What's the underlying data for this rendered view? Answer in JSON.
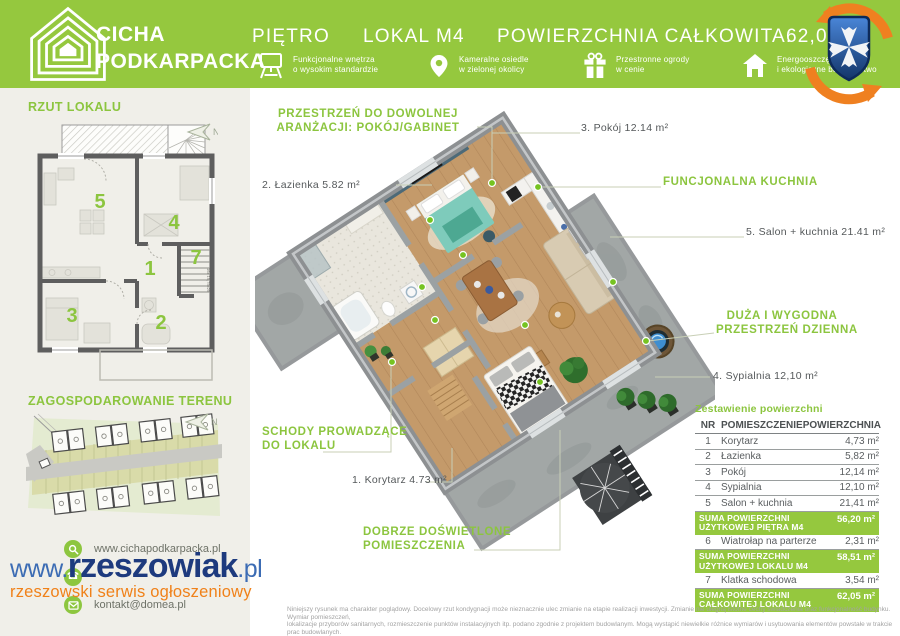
{
  "colors": {
    "green": "#95c83e",
    "green_text": "#8cc53f",
    "dark": "#54585a",
    "orange": "#f08119",
    "navy": "#1d3a7e",
    "blue": "#3c6cb4"
  },
  "header": {
    "brand_line1": "CICHA",
    "brand_line2": "PODKARPACKA",
    "floor_label": "PIĘTRO",
    "unit_label": "LOKAL M4",
    "total_area_label": "POWIERZCHNIA CAŁKOWITA:",
    "total_area_value": "62,05 m²",
    "features": [
      {
        "icon": "projector-icon",
        "line1": "Funkcjonalne wnętrza",
        "line2": "o wysokim standardzie"
      },
      {
        "icon": "map-pin-icon",
        "line1": "Kameralne osiedle",
        "line2": "w zielonej okolicy"
      },
      {
        "icon": "gift-icon",
        "line1": "Przestronne ogrody",
        "line2": "w cenie"
      },
      {
        "icon": "house-icon",
        "line1": "Energooszczędne",
        "line2": "i ekologiczne budownictwo"
      }
    ]
  },
  "sidebar": {
    "plan_title": "RZUT LOKALU",
    "site_title": "ZAGOSPODAROWANIE TERENU",
    "north_label": "N",
    "room_numbers": {
      "r1": "1",
      "r2": "2",
      "r3": "3",
      "r4": "4",
      "r5": "5",
      "r7": "7"
    },
    "stairs_note": "16x 19,75x25",
    "contacts": [
      {
        "icon": "search-icon",
        "label": "www.cichapodkarpacka.pl"
      },
      {
        "icon": "phone-icon",
        "label": ""
      },
      {
        "icon": "mail-icon",
        "label": "kontakt@domea.pl"
      }
    ]
  },
  "plan_labels": {
    "arrangement_line1": "PRZESTRZEŃ DO DOWOLNEJ",
    "arrangement_line2": "ARANŻACJI: POKÓJ/GABINET",
    "bathroom": "2. Łazienka 5.82 m²",
    "room3": "3. Pokój 12.14 m²",
    "kitchen": "FUNCJONALNA KUCHNIA",
    "living": "5. Salon + kuchnia 21.41 m²",
    "zone_line1": "DUŻA I WYGODNA",
    "zone_line2": "PRZESTRZEŃ DZIENNA",
    "bedroom": "4. Sypialnia 12,10 m²",
    "stairs_line1": "SCHODY PROWADZĄCE",
    "stairs_line2": "DO LOKALU",
    "corridor": "1. Korytarz 4.73 m²",
    "light_line1": "DOBRZE DOŚWIETLONE",
    "light_line2": "POMIESZCZENIA"
  },
  "area_table": {
    "title": "Zestawienie powierzchni",
    "columns": {
      "nr": "NR",
      "name": "POMIESZCZENIE",
      "area": "POWIERZCHNIA"
    },
    "rows": [
      {
        "nr": "1",
        "name": "Korytarz",
        "area": "4,73 m²"
      },
      {
        "nr": "2",
        "name": "Łazienka",
        "area": "5,82 m²"
      },
      {
        "nr": "3",
        "name": "Pokój",
        "area": "12,14 m²"
      },
      {
        "nr": "4",
        "name": "Sypialnia",
        "area": "12,10 m²"
      },
      {
        "nr": "5",
        "name": "Salon + kuchnia",
        "area": "21,41 m²"
      },
      {
        "name": "SUMA POWIERZCHNI UŻYTKOWEJ PIĘTRA M4",
        "area": "56,20 m²"
      },
      {
        "nr": "6",
        "name": "Wiatrołap na parterze",
        "area": "2,31 m²"
      },
      {
        "name": "SUMA POWIERZCHNI UŻYTKOWEJ LOKALU M4",
        "area": "58,51 m²"
      },
      {
        "nr": "7",
        "name": "Klatka schodowa",
        "area": "3,54 m²"
      },
      {
        "name": "SUMA POWIERZCHNI CAŁKOWITEJ LOKALU M4",
        "area": "62,05 m²"
      }
    ]
  },
  "watermark": {
    "www": "www.",
    "name": "rzeszowiak",
    "tld": ".pl",
    "tagline": "rzeszowski serwis ogłoszeniowy"
  },
  "footer": {
    "line1": "Niniejszy rysunek ma charakter poglądowy. Docelowy rzut kondygnacji może nieznacznie ulec zmianie na etapie realizacji inwestycji. Zmianie nie ulegną istotne cechy świadczenia oraz funkcjonalność budynku. Wymiar pomieszczeń,",
    "line2": "lokalizacje przyborów sanitarnych, rozmieszczenie punktów instalacyjnych itp. podano zgodnie z projektem budowlanym. Mogą wystąpić niewielkie różnice wymiarów i usytuowania elementów powstałe w trakcie prac budowlanych.",
    "line3": "Przedstawiona na rzucie aranżacja ma charakter przykładowy, umeblowanie nie stanowi wyposażenia nabywanego lokalu."
  }
}
